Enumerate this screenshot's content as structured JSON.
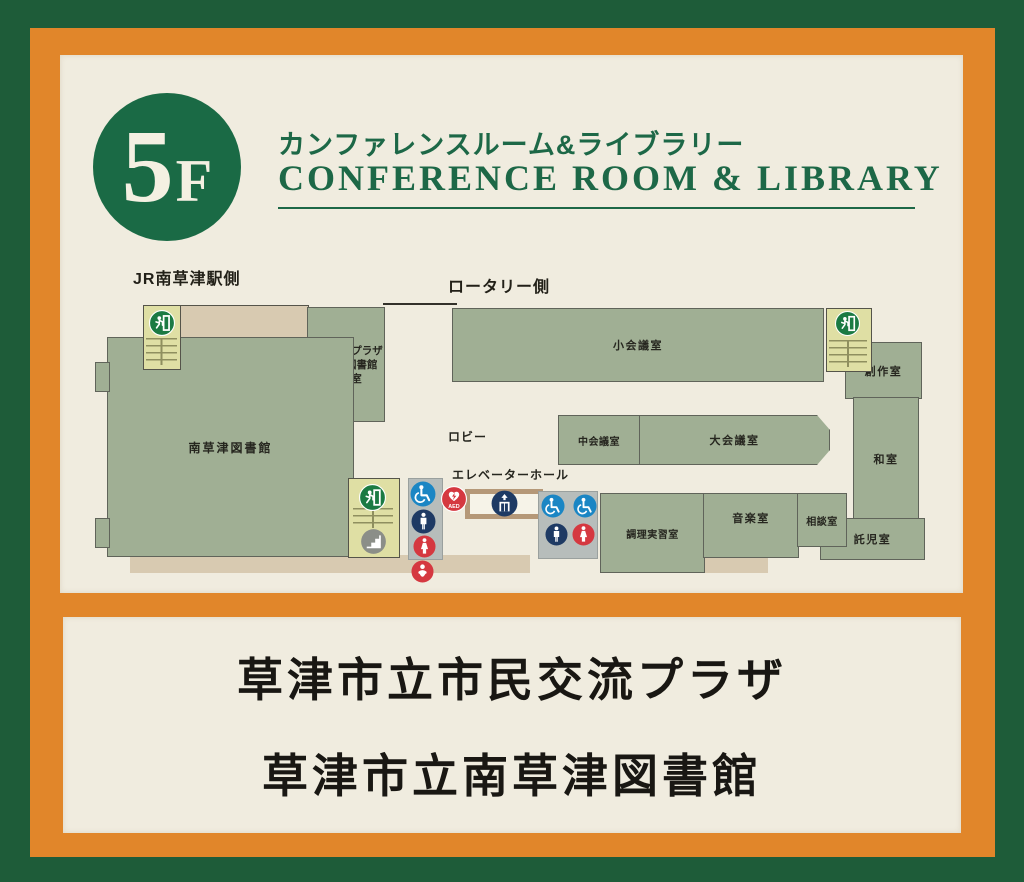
{
  "header": {
    "floor_number": "5",
    "floor_letter": "F",
    "title_ja": "カンファレンスルーム&ライブラリー",
    "title_en": "CONFERENCE ROOM & LIBRARY"
  },
  "map": {
    "direction_labels": {
      "station": "JR南草津駅側",
      "rotary": "ロータリー側"
    },
    "areas": {
      "lobby": "ロビー",
      "elevator_hall": "エレベーターホール"
    },
    "rooms": {
      "office_line1": "市民交流プラザ",
      "office_line2": "南草津図書館",
      "office_line3": "事務室",
      "small_meeting": "小会議室",
      "medium_meeting": "中会議室",
      "large_meeting": "大会議室",
      "library": "南草津図書館",
      "craft": "創作室",
      "japanese_room": "和室",
      "childcare": "託児室",
      "cooking": "調理実習室",
      "music": "音楽室",
      "consultation": "相談室"
    },
    "icons": {
      "aed_label": "AED"
    }
  },
  "footer": {
    "line1": "草津市立市民交流プラザ",
    "line2": "草津市立南草津図書館"
  },
  "colors": {
    "background_green": "#1e5c39",
    "frame_orange": "#e1862a",
    "panel_cream": "#f0ecdf",
    "header_green": "#1a6a45",
    "room_green": "#a0af94",
    "corridor_beige": "#d8cab1",
    "stair_yellow": "#dfdfa4",
    "exit_green": "#1b7a43",
    "toilet_blue": "#1b86c4",
    "toilet_red": "#d53840",
    "icon_navy": "#1e3a64",
    "stairs_gray": "#8b8e88"
  }
}
